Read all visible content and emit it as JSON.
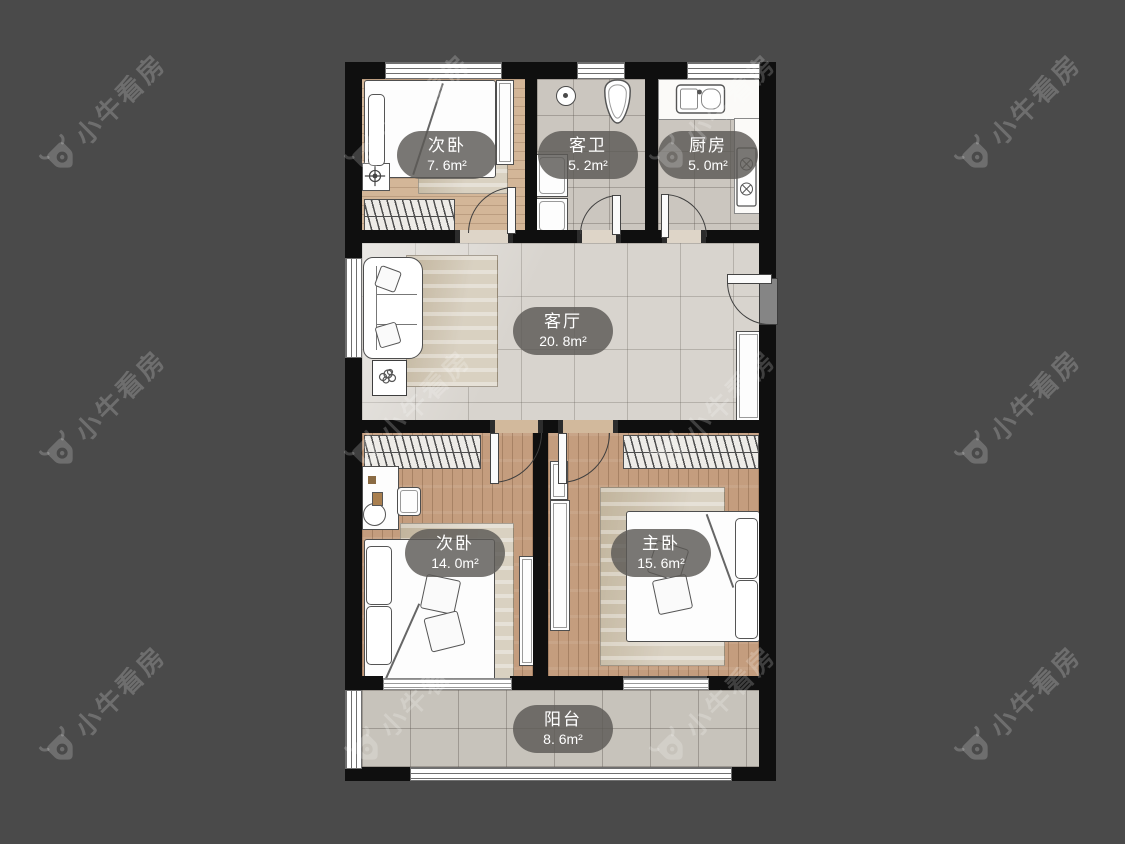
{
  "page": {
    "background_color": "#4a4a4a"
  },
  "watermark": {
    "text": "小牛看房",
    "icon": "bull-logo-icon",
    "color": "rgba(255,255,255,0.20)",
    "positions": [
      {
        "x": 105,
        "y": 113
      },
      {
        "x": 410,
        "y": 113
      },
      {
        "x": 715,
        "y": 113
      },
      {
        "x": 1020,
        "y": 113
      },
      {
        "x": 105,
        "y": 409
      },
      {
        "x": 410,
        "y": 409
      },
      {
        "x": 715,
        "y": 409
      },
      {
        "x": 1020,
        "y": 409
      },
      {
        "x": 105,
        "y": 705
      },
      {
        "x": 410,
        "y": 705
      },
      {
        "x": 715,
        "y": 705
      },
      {
        "x": 1020,
        "y": 705
      }
    ]
  },
  "floorplan": {
    "rooms": [
      {
        "id": "bedroom-top",
        "name": "次卧",
        "area": "7. 6m²"
      },
      {
        "id": "guest-bathroom",
        "name": "客卫",
        "area": "5. 2m²"
      },
      {
        "id": "kitchen",
        "name": "厨房",
        "area": "5. 0m²"
      },
      {
        "id": "living-room",
        "name": "客厅",
        "area": "20. 8m²"
      },
      {
        "id": "second-bedroom",
        "name": "次卧",
        "area": "14. 0m²"
      },
      {
        "id": "master-bedroom",
        "name": "主卧",
        "area": "15. 6m²"
      },
      {
        "id": "balcony",
        "name": "阳台",
        "area": "8. 6m²"
      }
    ],
    "label_style": {
      "pill_color": "rgba(92,89,85,0.82)",
      "text_color": "#ffffff"
    },
    "wall_color": "#0f0f0f"
  }
}
